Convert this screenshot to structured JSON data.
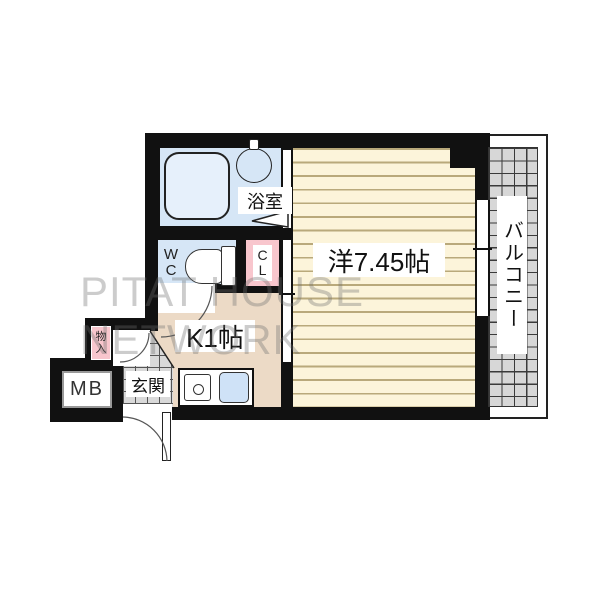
{
  "watermark": "PITAT HOUSE NETWORK",
  "floorplan": {
    "western_room": {
      "label": "洋7.45帖",
      "size_jo": "7.45"
    },
    "kitchen": {
      "label": "K1帖",
      "size_jo": "1"
    },
    "bathroom": {
      "label": "浴室"
    },
    "entrance": {
      "label": "玄関"
    },
    "balcony": {
      "label": "バルコニー"
    },
    "wc": {
      "char1": "W",
      "char2": "C"
    },
    "closet": {
      "char1": "C",
      "char2": "L"
    },
    "storage": {
      "char1": "物",
      "char2": "入"
    },
    "meter_box": {
      "label": "MB"
    }
  },
  "colors": {
    "wall": "#111111",
    "water_blue": "#d6e6f6",
    "closet_pink": "#f8c6cd",
    "kitchen_tan": "#ecdac6",
    "room_cream": "#fcf4da",
    "floor_stripe": "#b9a97b",
    "tile_gray": "#d9d9d9",
    "watermark_gray": "#6e6e6e"
  }
}
